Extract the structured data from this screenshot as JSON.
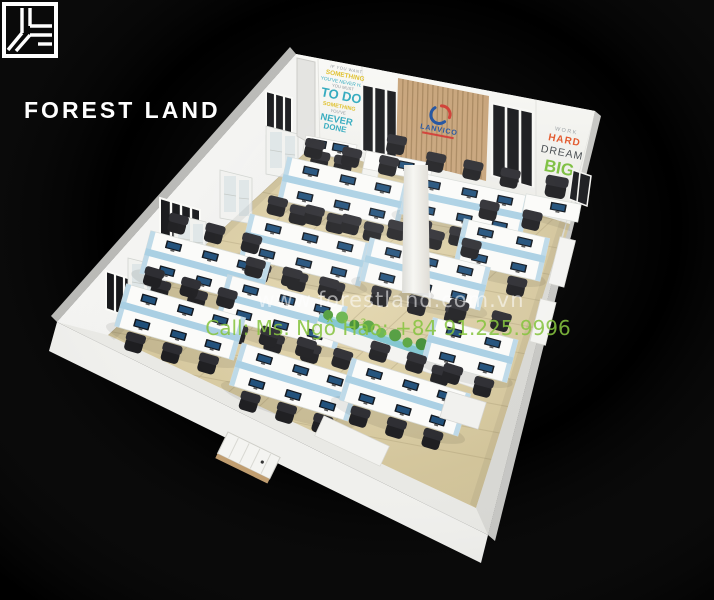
{
  "branding": {
    "logo_text": "FOREST LAND"
  },
  "watermark": {
    "line1": "www.forestland.com.vn",
    "line2": "Call: Ms. Ngô Hảo: +84 91.225.9996"
  },
  "office": {
    "company_logo": {
      "name": "LANVICO"
    },
    "quote_wall": {
      "lines": [
        {
          "text": "IF YOU WANT",
          "color": "#8e959b"
        },
        {
          "text": "SOMETHING",
          "color": "#dfc02c"
        },
        {
          "text": "YOU'VE NEVER HAD",
          "color": "#2fa9bd"
        },
        {
          "text": "YOU MUST",
          "color": "#8e959b"
        },
        {
          "text": "TO DO",
          "color": "#2fa9bd"
        },
        {
          "text": "SOMETHING",
          "color": "#dfc02c"
        },
        {
          "text": "YOU'VE",
          "color": "#8e959b"
        },
        {
          "text": "NEVER",
          "color": "#2fa9bd"
        },
        {
          "text": "DONE",
          "color": "#2fa9bd"
        }
      ]
    },
    "slogan_wall": {
      "lines": [
        {
          "text": "WORK",
          "color": "#9aa0a4"
        },
        {
          "text": "HARD",
          "color": "#e2572b"
        },
        {
          "text": "DREAM",
          "color": "#43484c"
        },
        {
          "text": "BIG",
          "color": "#7cbf3f"
        }
      ]
    },
    "colors": {
      "background": "#000000",
      "floor": "#dbcda3",
      "walls": "#f7f7f4",
      "wood_panel": "#c7a379",
      "desk": "#fbfbf9",
      "divider": "#a9cfe3",
      "chair": "#1d1d20",
      "plant": "#57a43e",
      "logo_blue": "#1c4f9e",
      "logo_red": "#cf3a31",
      "watermark_green": "#86c440"
    }
  }
}
